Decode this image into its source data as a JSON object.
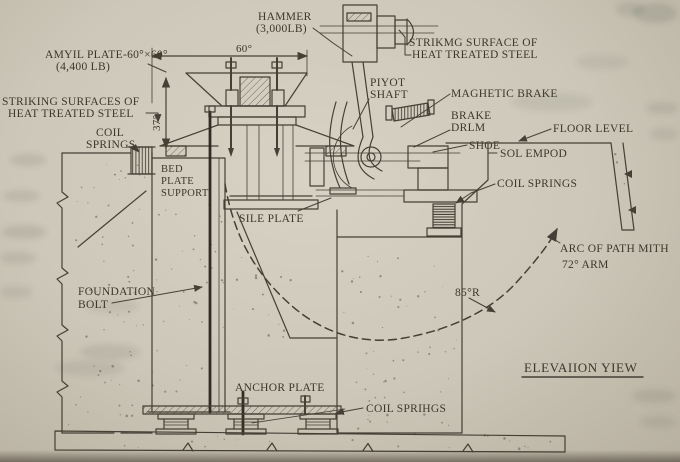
{
  "diagram": {
    "type": "engineering-elevation-drawing",
    "view_title": "ELEVAIION YIEW",
    "ink_color": "#453f35",
    "paper_color": "#cdc7b9",
    "labels": {
      "hammer_1": "HAMMER",
      "hammer_2": "(3,000LB)",
      "strike_surface_top_1": "STRIKMG SURFACE OF",
      "strike_surface_top_2": "HEAT TREATED STEEL",
      "anvil_plate_1": "AMYIL PLATE-60°×60°",
      "anvil_plate_2": "(4,400 LB)",
      "striking_surfaces_left_1": "STRIKING SURFACES OF",
      "striking_surfaces_left_2": "HEAT TREATED STEEL",
      "coil_springs_left_1": "COIL",
      "coil_springs_left_2": "SPRINGS",
      "bed_plate_support_1": "BED",
      "bed_plate_support_2": "PLATE",
      "bed_plate_support_3": "SUPPORT",
      "pivot_shaft_1": "PIYOT",
      "pivot_shaft_2": "SHAFT",
      "magnetic_brake": "MAGHETIC BRAKE",
      "brake_drum_1": "BRAKE",
      "brake_drum_2": "DRLM",
      "shoe": "SHOE",
      "floor_level": "FLOOR LEVEL",
      "solenoid": "SOL EMPOD",
      "coil_springs_right": "COIL SPRINGS",
      "arc_of_path_1": "ARC OF PATH MITH",
      "arc_of_path_2": "72° ARM",
      "radius": "85°R",
      "sole_plate": "SILE PLATE",
      "foundation_bolt_1": "FOUNDATION",
      "foundation_bolt_2": "BOLT",
      "anchor_plate": "ANCHOR PLATE",
      "coil_springs_bottom": "COIL SPRIHGS",
      "dim_width": "60°",
      "dim_height": "37°"
    }
  }
}
